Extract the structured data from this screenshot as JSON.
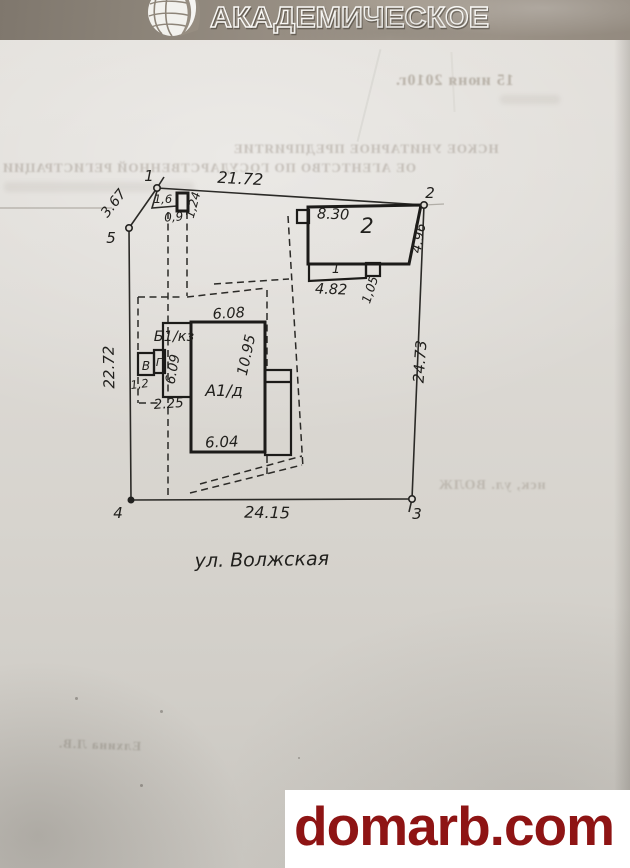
{
  "header": {
    "brand": "АКАДЕМИЧЕСКОЕ"
  },
  "plan": {
    "street": "ул. Волжская",
    "vertices": {
      "v1": "1",
      "v2": "2",
      "v3": "3",
      "v4": "4",
      "v5": "5"
    },
    "boundary": {
      "side_5_1": "3.67",
      "side_1_2": "21.72",
      "side_2_3": "24.73",
      "side_3_4": "24.15",
      "side_4_5": "22.72"
    },
    "bld2": {
      "label": "2",
      "porch_label": "1",
      "top": "8.30",
      "right": "4.96",
      "porch_width": "4.82",
      "porch_depth": "1,05"
    },
    "a1": {
      "label": "А1/д",
      "top": "6.08",
      "right": "10.95",
      "bottom": "6.04"
    },
    "b1": {
      "label": "Б1/кз",
      "height": "6.09",
      "width": "2.25"
    },
    "sheds": {
      "v_label": "В",
      "g_label": "Г",
      "width": "1,2"
    },
    "gate": {
      "width": "1,6",
      "depth": "0,9",
      "side": "1,24"
    }
  },
  "bleedthrough": {
    "date": "15 июня 2010г.",
    "line1": "НСКОЕ УНИТАРНОЕ ПРЕДПРИЯТИЕ",
    "line2": "ОЕ АГЕНТСТВО ПО ГОСУДАРСТВЕННОЙ РЕГИСТРАЦИИ",
    "address": "нск, ул. ВОЛЖ",
    "signature": "Елхина Л.В."
  },
  "watermark": {
    "text": "domarb.com",
    "color": "#8e1414"
  }
}
